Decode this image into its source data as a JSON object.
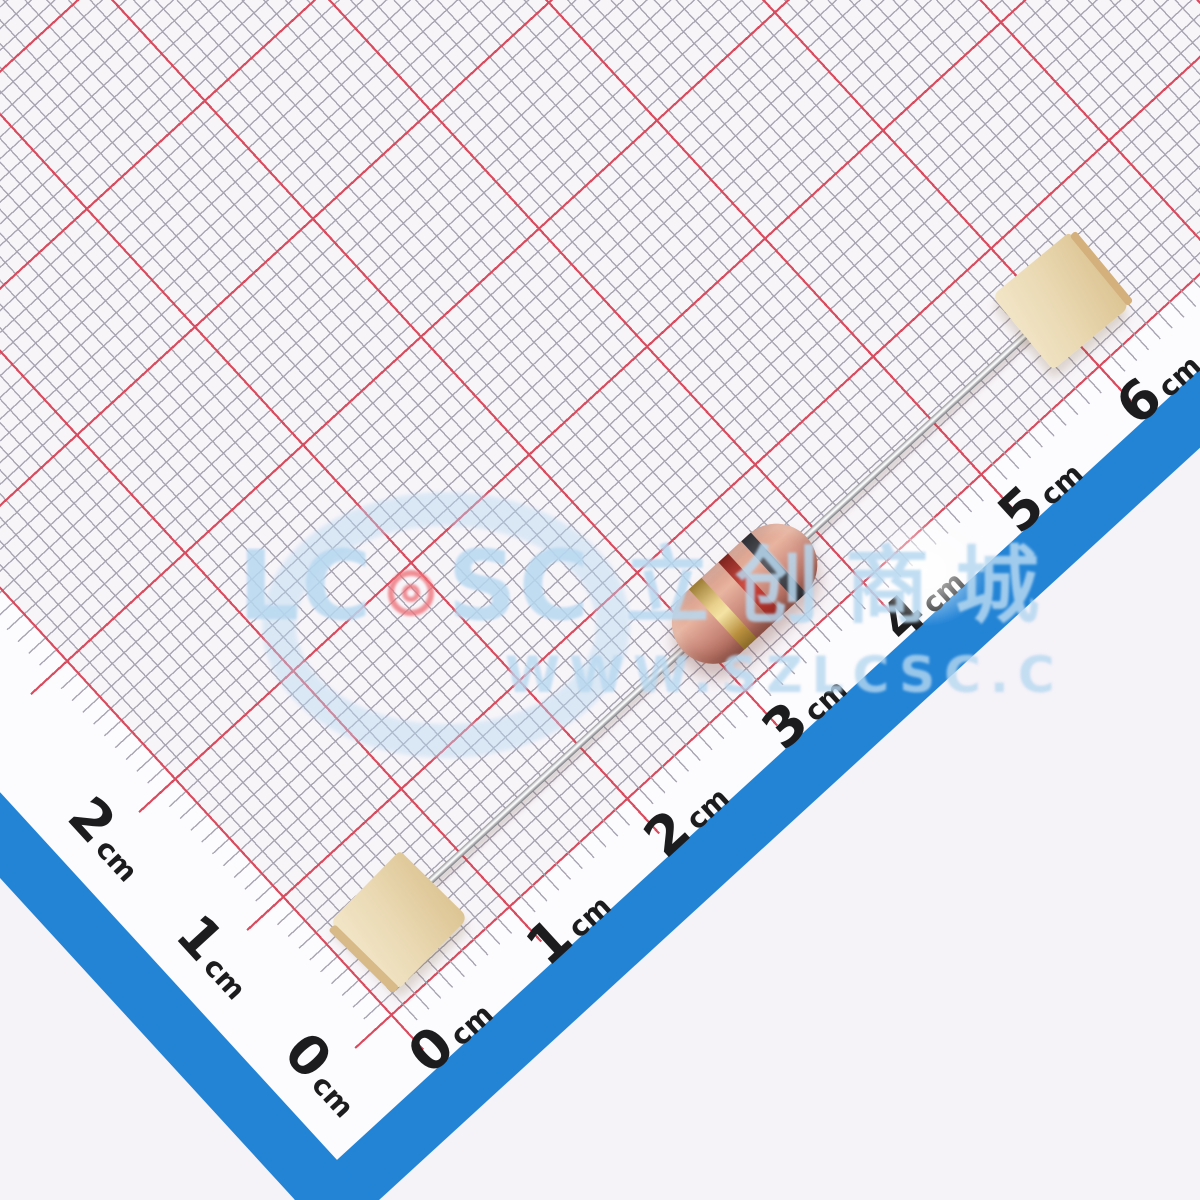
{
  "photo": {
    "ruler": {
      "unit": "cm",
      "bottom_ticks": [
        "0",
        "1",
        "2",
        "3",
        "4",
        "5",
        "6"
      ],
      "left_ticks": [
        "0",
        "1",
        "2"
      ]
    },
    "watermark": {
      "brand_left": "LC",
      "brand_right": "SC",
      "brand_cn": "立创商城",
      "url": "WWW.SZLCSC.C"
    },
    "colors": {
      "outside": "#f5f2f8",
      "paper": "#fcfbfd",
      "frame_blue": "#2384d6",
      "grid_red": "#d94b5e",
      "grid_gray": "#a9a5b3",
      "watermark_blue": "#b7d8f0",
      "logo_red": "#ee7077",
      "resistor_body": "#d29384",
      "resistor_band_1_dark_gray": "#4a4c53",
      "resistor_band_2_red": "#c03a32",
      "resistor_band_3_gold": "#d8b96a",
      "tape_kraft": "#ead9b3",
      "lead_silver": "#c6c7ca"
    }
  }
}
